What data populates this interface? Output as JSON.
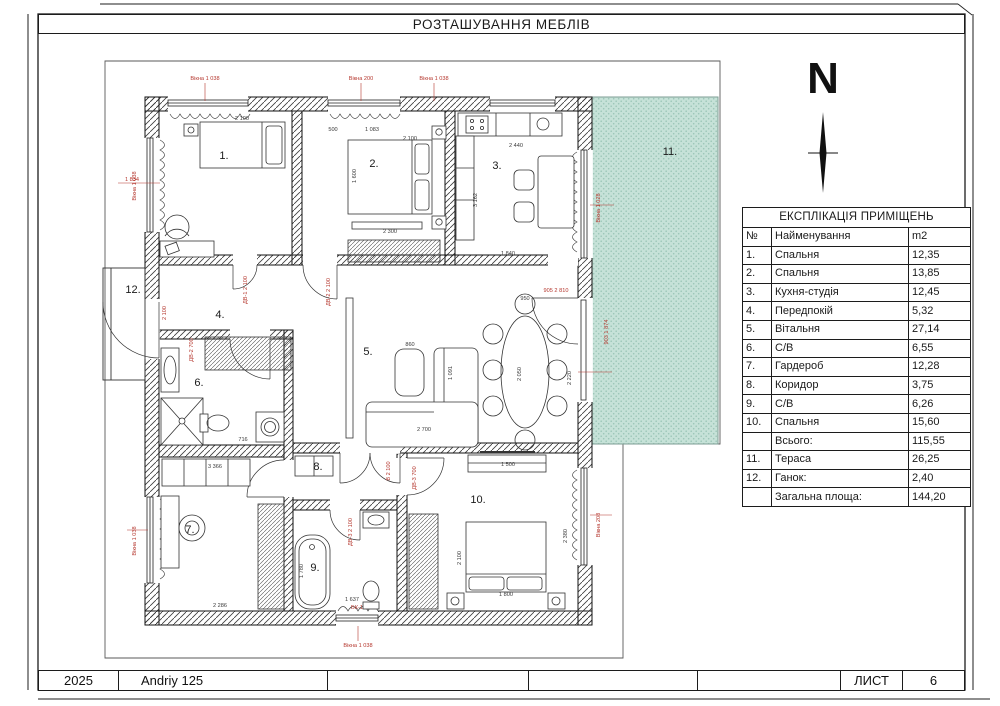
{
  "page": {
    "title": "РОЗТАШУВАННЯ МЕБЛІВ",
    "north_label": "N"
  },
  "legend_table": {
    "title": "ЕКСПЛІКАЦІЯ ПРИМІЩЕНЬ",
    "columns": {
      "num": "№",
      "name": "Найменування",
      "area": "m2"
    },
    "rows": [
      {
        "num": "1.",
        "name": "Спальня",
        "area": "12,35"
      },
      {
        "num": "2.",
        "name": "Спальня",
        "area": "13,85"
      },
      {
        "num": "3.",
        "name": "Кухня-студія",
        "area": "12,45"
      },
      {
        "num": "4.",
        "name": "Передпокій",
        "area": "5,32"
      },
      {
        "num": "5.",
        "name": "Вітальня",
        "area": "27,14"
      },
      {
        "num": "6.",
        "name": "С/В",
        "area": "6,55"
      },
      {
        "num": "7.",
        "name": "Гардероб",
        "area": "12,28"
      },
      {
        "num": "8.",
        "name": "Коридор",
        "area": "3,75"
      },
      {
        "num": "9.",
        "name": "С/В",
        "area": "6,26"
      },
      {
        "num": "10.",
        "name": "Спальня",
        "area": "15,60"
      },
      {
        "num": "",
        "name": "Всього:",
        "area": "115,55",
        "merge": true
      },
      {
        "num": "11.",
        "name": "Тераса",
        "area": "26,25"
      },
      {
        "num": "12.",
        "name": "Ганок:",
        "area": "2,40"
      },
      {
        "num": "",
        "name": "Загальна площа:",
        "area": "144,20",
        "merge": true
      }
    ]
  },
  "footer": {
    "cells": [
      "2025",
      "Andriy 125",
      "",
      "",
      "",
      "ЛИСТ",
      "6"
    ]
  },
  "plan": {
    "colors": {
      "terrace_fill": "#c6e2d8",
      "terrace_dot": "#9cc6b8",
      "annotation_red": "#b5372e",
      "line": "#1a1a1a"
    },
    "rooms": [
      {
        "label": "1.",
        "x": 224,
        "y": 159
      },
      {
        "label": "2.",
        "x": 374,
        "y": 167
      },
      {
        "label": "3.",
        "x": 497,
        "y": 169
      },
      {
        "label": "4.",
        "x": 220,
        "y": 318
      },
      {
        "label": "5.",
        "x": 368,
        "y": 355
      },
      {
        "label": "6.",
        "x": 199,
        "y": 386
      },
      {
        "label": "7.",
        "x": 190,
        "y": 533
      },
      {
        "label": "8.",
        "x": 318,
        "y": 470
      },
      {
        "label": "9.",
        "x": 315,
        "y": 571
      },
      {
        "label": "10.",
        "x": 478,
        "y": 503
      },
      {
        "label": "11.",
        "x": 670,
        "y": 155
      },
      {
        "label": "12.",
        "x": 133,
        "y": 293
      }
    ],
    "annotations": [
      {
        "text": "Вікна 1 038",
        "x": 205,
        "y": 80,
        "color": "red"
      },
      {
        "text": "Вікна 200",
        "x": 361,
        "y": 80,
        "color": "red"
      },
      {
        "text": "Вікна 1 038",
        "x": 434,
        "y": 80,
        "color": "red"
      },
      {
        "text": "Вікна 1 038",
        "x": 136,
        "y": 186,
        "rot": -90,
        "color": "red"
      },
      {
        "text": "Вікна 1 038",
        "x": 136,
        "y": 541,
        "rot": -90,
        "color": "red"
      },
      {
        "text": "Вікна 1 028",
        "x": 600,
        "y": 208,
        "rot": -90,
        "color": "red"
      },
      {
        "text": "903  1 874",
        "x": 608,
        "y": 332,
        "rot": -90,
        "color": "red"
      },
      {
        "text": "Вікна 208",
        "x": 600,
        "y": 525,
        "rot": -90,
        "color": "red"
      },
      {
        "text": "905  2 810",
        "x": 556,
        "y": 292,
        "color": "red"
      },
      {
        "text": "БК-1",
        "x": 357,
        "y": 609,
        "color": "red"
      },
      {
        "text": "Вікна 1 038",
        "x": 358,
        "y": 647,
        "color": "red"
      },
      {
        "text": "ДВ-1  2 100",
        "x": 247,
        "y": 290,
        "rot": -90,
        "color": "red"
      },
      {
        "text": "ДВ-2  2 100",
        "x": 330,
        "y": 292,
        "rot": -90,
        "color": "red"
      },
      {
        "text": "ДВ-2  700",
        "x": 193,
        "y": 350,
        "rot": -90,
        "color": "red"
      },
      {
        "text": "ДВ-3  2 100",
        "x": 352,
        "y": 532,
        "rot": -90,
        "color": "red"
      },
      {
        "text": "ДВ-3  700",
        "x": 416,
        "y": 478,
        "rot": -90,
        "color": "red"
      },
      {
        "text": "В 2 100",
        "x": 390,
        "y": 471,
        "rot": -90,
        "color": "red"
      },
      {
        "text": "1 834",
        "x": 132,
        "y": 181,
        "color": "red"
      },
      {
        "text": "2 100",
        "x": 166,
        "y": 313,
        "rot": -90,
        "color": "red"
      },
      {
        "text": "2 100",
        "x": 242,
        "y": 120
      },
      {
        "text": "500",
        "x": 333,
        "y": 131
      },
      {
        "text": "1 083",
        "x": 372,
        "y": 131
      },
      {
        "text": "2 100",
        "x": 410,
        "y": 140
      },
      {
        "text": "1 600",
        "x": 356,
        "y": 176,
        "rot": -90
      },
      {
        "text": "2 300",
        "x": 390,
        "y": 233
      },
      {
        "text": "2 440",
        "x": 516,
        "y": 147
      },
      {
        "text": "3 162",
        "x": 477,
        "y": 200,
        "rot": -90
      },
      {
        "text": "1 840",
        "x": 508,
        "y": 255
      },
      {
        "text": "860",
        "x": 410,
        "y": 346
      },
      {
        "text": "950",
        "x": 525,
        "y": 300
      },
      {
        "text": "2 050",
        "x": 521,
        "y": 374,
        "rot": -90
      },
      {
        "text": "1 091",
        "x": 452,
        "y": 373,
        "rot": -90
      },
      {
        "text": "2 220",
        "x": 571,
        "y": 378,
        "rot": -90
      },
      {
        "text": "2 700",
        "x": 424,
        "y": 431
      },
      {
        "text": "3 366",
        "x": 215,
        "y": 468
      },
      {
        "text": "2 286",
        "x": 220,
        "y": 607
      },
      {
        "text": "1 780",
        "x": 303,
        "y": 571,
        "rot": -90
      },
      {
        "text": "1 637",
        "x": 352,
        "y": 601
      },
      {
        "text": "716",
        "x": 243,
        "y": 441
      },
      {
        "text": "1 500",
        "x": 508,
        "y": 466
      },
      {
        "text": "2 100",
        "x": 461,
        "y": 558,
        "rot": -90
      },
      {
        "text": "1 800",
        "x": 506,
        "y": 596
      },
      {
        "text": "2 380",
        "x": 567,
        "y": 536,
        "rot": -90
      }
    ]
  }
}
